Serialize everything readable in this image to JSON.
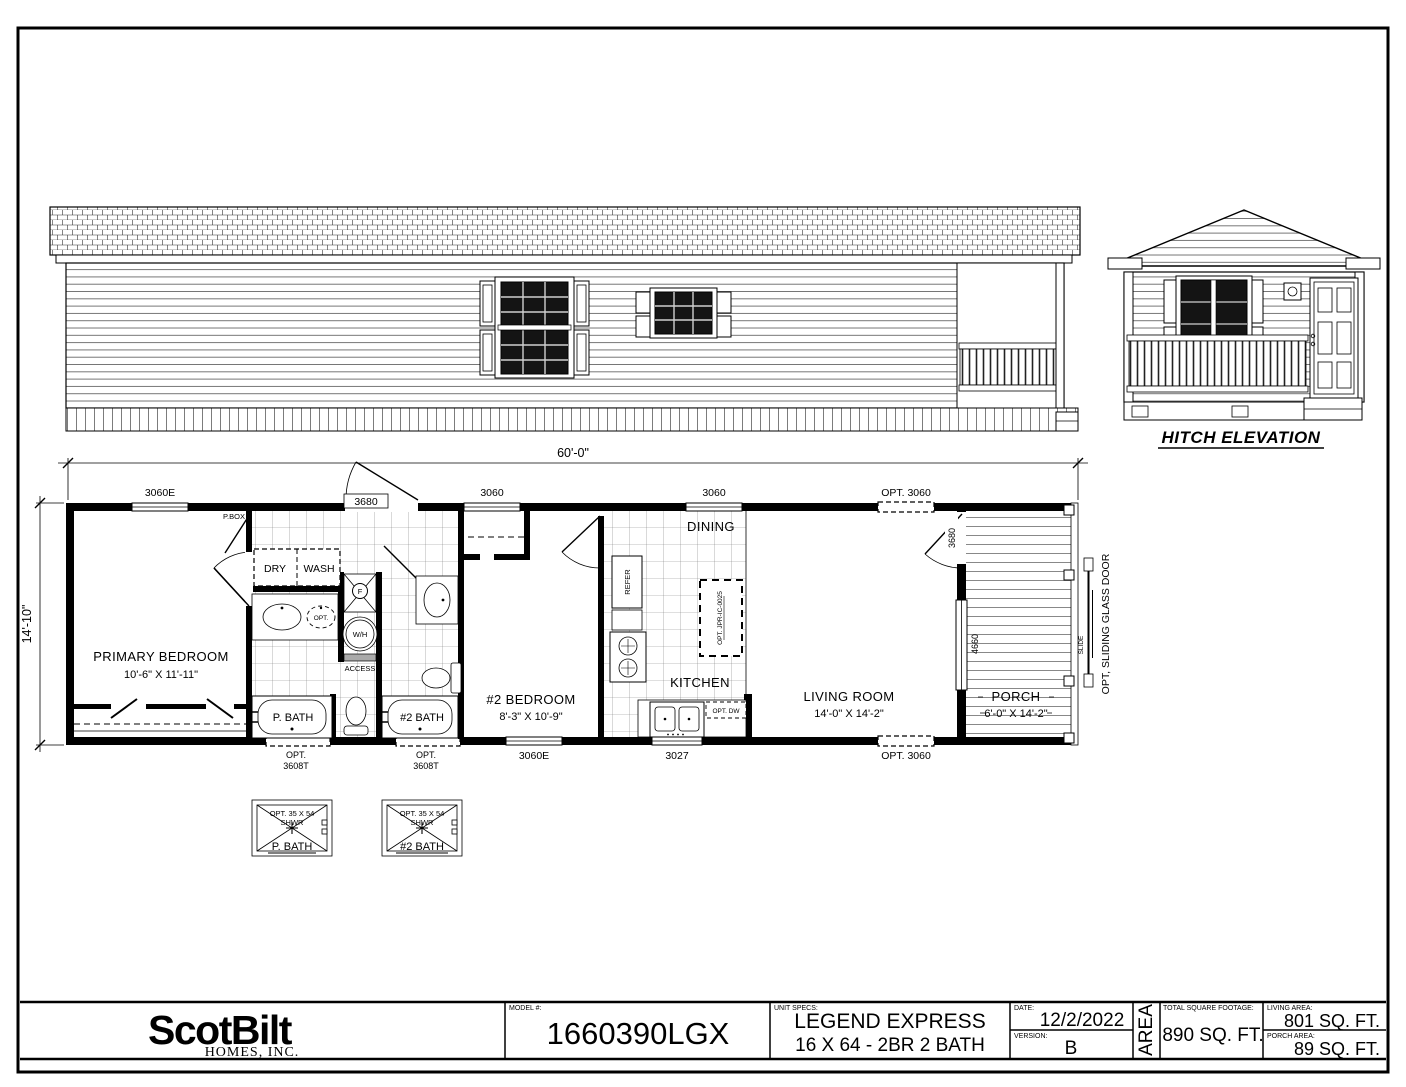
{
  "colors": {
    "ink": "#000000",
    "paper": "#ffffff",
    "glass": "#141414"
  },
  "hitch_elevation": {
    "label": "HITCH ELEVATION"
  },
  "floor_plan": {
    "overall_width": "60'-0\"",
    "overall_depth": "14'-10\"",
    "top_openings": {
      "w1": "3060E",
      "door": "3680",
      "w2": "3060",
      "w3": "3060",
      "w4": "OPT. 3060"
    },
    "bottom_openings": {
      "b1_line1": "OPT.",
      "b1_line2": "3608T",
      "b2_line1": "OPT.",
      "b2_line2": "3608T",
      "b3": "3060E",
      "b4": "3027",
      "b5": "OPT. 3060"
    },
    "rooms": {
      "primary_bedroom": {
        "name": "PRIMARY BEDROOM",
        "size": "10'-6\" X 11'-11\""
      },
      "bedroom2": {
        "name": "#2 BEDROOM",
        "size": "8'-3\" X 10'-9\""
      },
      "dining": "DINING",
      "kitchen": "KITCHEN",
      "living_room": {
        "name": "LIVING ROOM",
        "size": "14'-0\" X 14'-2\""
      },
      "porch": {
        "name": "PORCH",
        "size": "6'-0\" X 14'-2\""
      },
      "p_bath": "P. BATH",
      "bath2": "#2 BATH"
    },
    "fixtures": {
      "pbox": "P.BOX",
      "dry": "DRY",
      "wash": "WASH",
      "opt_sink": "OPT.",
      "furnace": "F",
      "water_heater": "W/H",
      "access": "ACCESS",
      "refer": "REFER",
      "island": "OPT. JPR-IC-0025",
      "dishwasher": "OPT. DW",
      "porch_door": "3680",
      "porch_window": "4660",
      "sliding_door_note": "OPT, SLIDING GLASS DOOR",
      "slide": "SLIDE"
    }
  },
  "shower_options": {
    "opt1": {
      "line1": "OPT. 35 X 54",
      "line2": "SHWR",
      "label": "P. BATH"
    },
    "opt2": {
      "line1": "OPT. 35 X 54",
      "line2": "SHWR",
      "label": "#2 BATH"
    }
  },
  "title_block": {
    "logo": "ScotBilt",
    "logo_sub": "HOMES, INC.",
    "model_label": "MODEL #:",
    "model_value": "1660390LGX",
    "unit_specs_label": "UNIT SPECS:",
    "unit_specs_line1": "LEGEND EXPRESS",
    "unit_specs_line2": "16 X 64 - 2BR 2 BATH",
    "date_label": "DATE:",
    "date_value": "12/2/2022",
    "version_label": "VERSION:",
    "version_value": "B",
    "area_label": "AREA",
    "total_label": "TOTAL SQUARE FOOTAGE:",
    "total_value": "890 SQ. FT.",
    "living_label": "LIVING AREA:",
    "living_value": "801 SQ. FT.",
    "porch_label": "PORCH AREA:",
    "porch_value": "89 SQ. FT."
  }
}
